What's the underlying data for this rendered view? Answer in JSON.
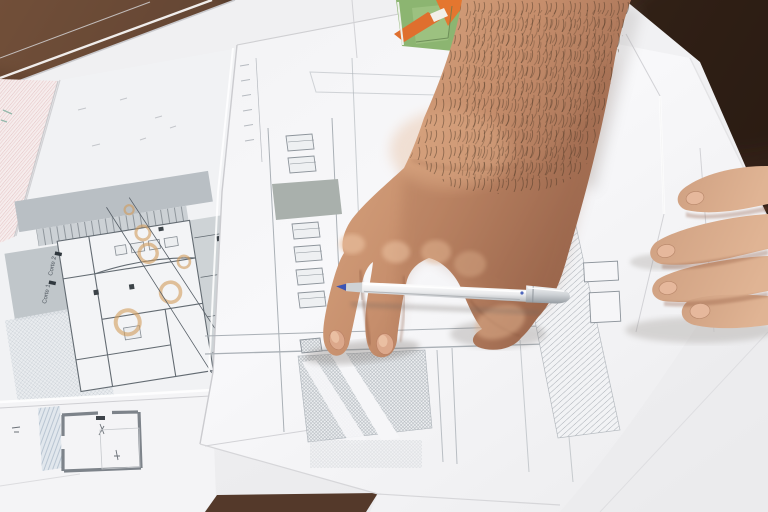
{
  "scene": {
    "description": "Photograph: architect's hand holding a white ballpoint pen between fingers, pointing at a building elevation blueprint; floor plan sheet at left; second hand resting on sheet at right; dark wood table beneath",
    "table_color": "#4a3326",
    "paper_color": "#f4f4f6",
    "skin_color": "#c89373"
  },
  "plan": {
    "section_labels": [
      {
        "text": "Corte 2"
      },
      {
        "text": "Corte 1"
      }
    ],
    "gray_fill": "#bcc2c6",
    "accent_circle_color": "#dfae74"
  },
  "elevation": {
    "line_color": "#9aa0a6",
    "gray_block_color": "#a9b0ac",
    "hatch_color": "#9aa0a8"
  },
  "pen": {
    "body_color": "#f4f5f6",
    "tip_color": "#3b55b5",
    "clip_color": "#23367d",
    "cap_color": "#c9ccd0"
  },
  "model": {
    "base_color": "#8cb571",
    "roof_color": "#df6f2e"
  }
}
